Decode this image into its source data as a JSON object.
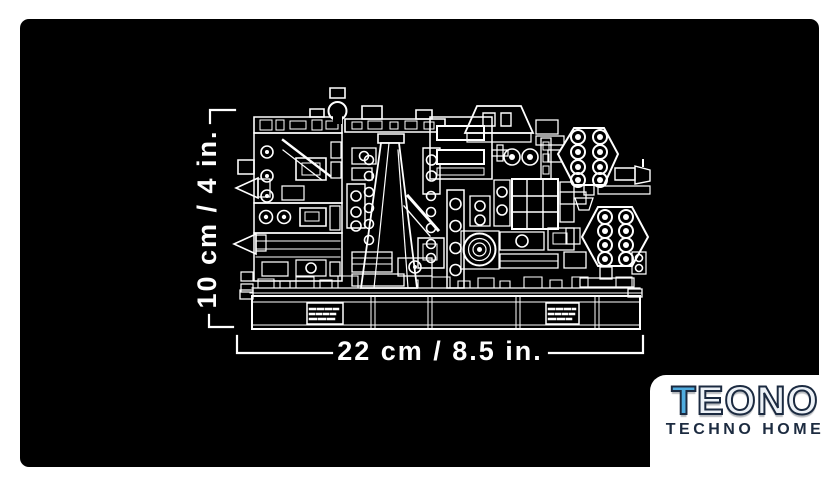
{
  "dimensions": {
    "height_label": "10 cm / 4 in.",
    "width_label": "22 cm / 8.5 in."
  },
  "logo": {
    "brand": "TEONO",
    "brand_first": "T",
    "brand_rest": "EONO",
    "tagline": "TECHNO HOME"
  },
  "art": {
    "name": "lego-diorama-line-art"
  },
  "colors": {
    "canvas": "#000000",
    "frame": "#ffffff",
    "line_art": "#ffffff",
    "logo_navy": "#1b2a40",
    "logo_blue": "#4facdf",
    "logo_silver": "#edf2f7"
  }
}
